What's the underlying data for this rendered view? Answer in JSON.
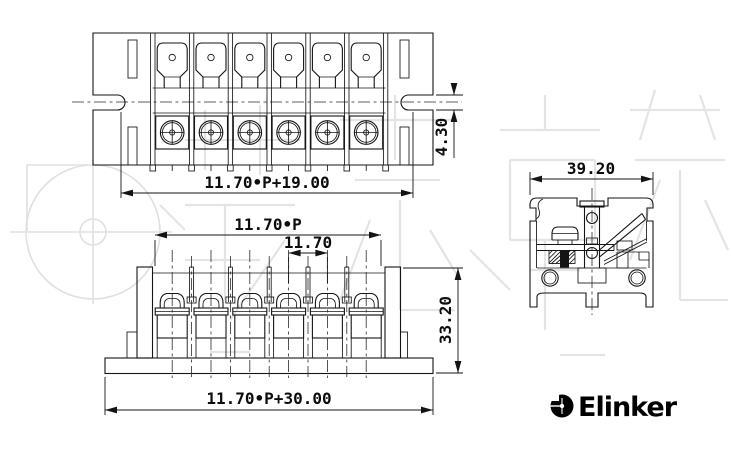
{
  "dimensions": {
    "plan_width": "11.70•P+19.00",
    "plan_slot_height": "4.30",
    "front_pitch_total": "11.70•P",
    "front_pitch": "11.70",
    "front_height": "33.20",
    "front_base_width": "11.70•P+30.00",
    "side_width": "39.20"
  },
  "logo": {
    "text": "Elinker"
  },
  "colors": {
    "line": "#141414",
    "centerline": "#2b2b2b",
    "watermark": "#e4e4e4",
    "logo": "#000000",
    "background": "#ffffff"
  }
}
